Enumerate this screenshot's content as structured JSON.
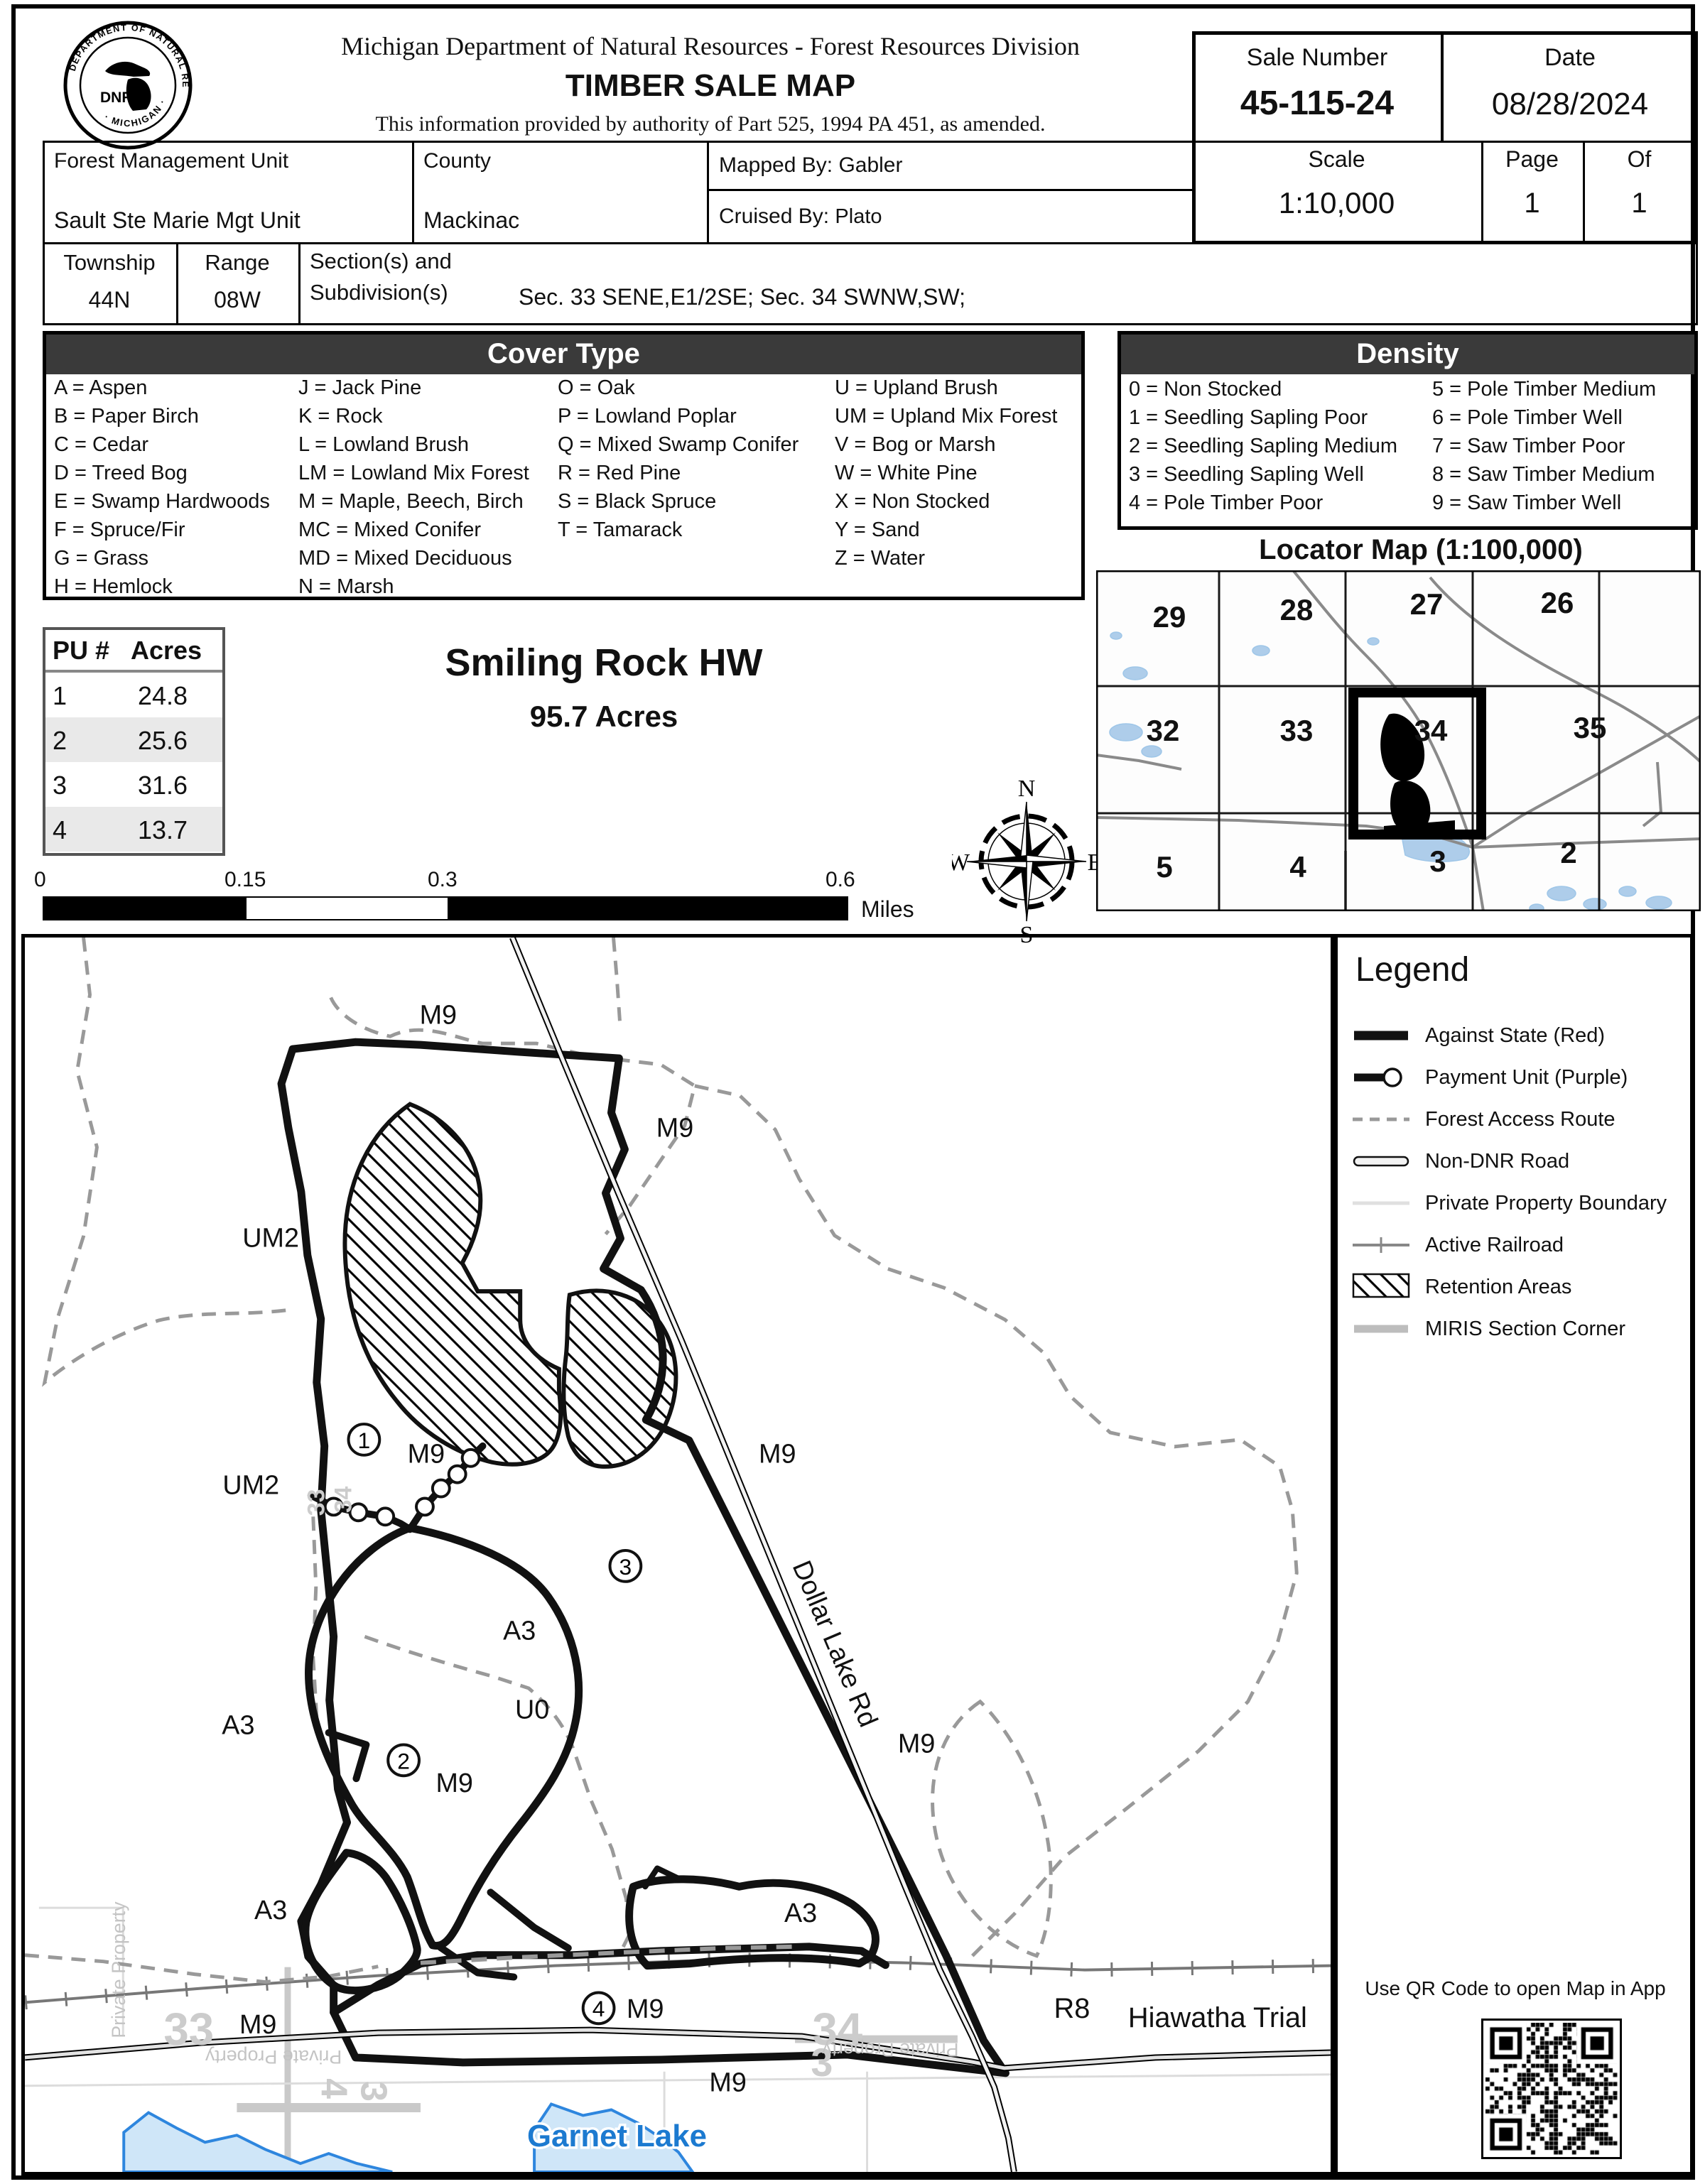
{
  "header": {
    "agency_line": "Michigan Department of Natural Resources - Forest Resources Division",
    "title": "TIMBER SALE MAP",
    "authority_line": "This information provided by authority of Part 525, 1994 PA 451, as amended.",
    "sale_number_label": "Sale Number",
    "sale_number": "45-115-24",
    "date_label": "Date",
    "date": "08/28/2024"
  },
  "logo": {
    "arc_top": "DEPARTMENT OF NATURAL RESOURCES",
    "arc_bottom": "· MICHIGAN ·",
    "dnr": "DNR"
  },
  "info_table": {
    "fmu_label": "Forest Management Unit",
    "fmu_value": "Sault Ste Marie Mgt Unit",
    "county_label": "County",
    "county_value": "Mackinac",
    "mapped_by_label": "Mapped By:",
    "mapped_by_value": "Gabler",
    "cruised_by_label": "Cruised By:",
    "cruised_by_value": "Plato",
    "scale_label": "Scale",
    "scale_value": "1:10,000",
    "page_label": "Page",
    "page_value": "1",
    "of_label": "Of",
    "of_value": "1",
    "township_label": "Township",
    "township_value": "44N",
    "range_label": "Range",
    "range_value": "08W",
    "sections_label_line1": "Section(s) and",
    "sections_label_line2": "Subdivision(s)",
    "sections_value": "Sec. 33 SENE,E1/2SE; Sec. 34 SWNW,SW;"
  },
  "cover_type": {
    "title": "Cover Type",
    "col1": [
      "A = Aspen",
      "B = Paper Birch",
      "C = Cedar",
      "D = Treed Bog",
      "E = Swamp Hardwoods",
      "F = Spruce/Fir",
      "G = Grass",
      "H = Hemlock"
    ],
    "col2": [
      "J = Jack Pine",
      "K = Rock",
      "L = Lowland Brush",
      "LM = Lowland Mix Forest",
      "M = Maple, Beech, Birch",
      "MC = Mixed Conifer",
      "MD = Mixed Deciduous",
      "N = Marsh"
    ],
    "col3": [
      "O = Oak",
      "P = Lowland Poplar",
      "Q = Mixed Swamp Conifer",
      "R = Red Pine",
      "S = Black Spruce",
      "T = Tamarack"
    ],
    "col4": [
      "U = Upland Brush",
      "UM = Upland Mix Forest",
      "V = Bog or Marsh",
      "W = White Pine",
      "X = Non Stocked",
      "Y = Sand",
      "Z = Water"
    ]
  },
  "density": {
    "title": "Density",
    "col1": [
      "0 = Non Stocked",
      "1 = Seedling Sapling Poor",
      "2 = Seedling Sapling Medium",
      "3 = Seedling Sapling Well",
      "4 = Pole Timber Poor"
    ],
    "col2": [
      "5 = Pole Timber Medium",
      "6 = Pole Timber Well",
      "7 = Saw Timber Poor",
      "8 = Saw Timber Medium",
      "9 = Saw Timber Well"
    ]
  },
  "pu_table": {
    "header": [
      "PU #",
      "Acres"
    ],
    "rows": [
      [
        "1",
        "24.8"
      ],
      [
        "2",
        "25.6"
      ],
      [
        "3",
        "31.6"
      ],
      [
        "4",
        "13.7"
      ]
    ]
  },
  "sale": {
    "name": "Smiling Rock HW",
    "acres": "95.7 Acres"
  },
  "locator": {
    "title": "Locator Map (1:100,000)",
    "sections_row1": [
      "29",
      "28",
      "27",
      "26"
    ],
    "sections_row2": [
      "32",
      "33",
      "34",
      "35"
    ],
    "sections_row3": [
      "5",
      "4",
      "3",
      "2"
    ]
  },
  "compass": {
    "n": "N",
    "e": "E",
    "s": "S",
    "w": "W"
  },
  "scale_bar": {
    "ticks": [
      "0",
      "0.15",
      "0.3",
      "0.6"
    ],
    "unit": "Miles"
  },
  "legend": {
    "title": "Legend",
    "items": [
      "Against State (Red)",
      "Payment Unit (Purple)",
      "Forest Access Route",
      "Non-DNR Road",
      "Private Property Boundary",
      "Active Railroad",
      "Retention Areas",
      "MIRIS Section Corner"
    ]
  },
  "qr": {
    "caption": "Use QR Code to open Map in App"
  },
  "map": {
    "labels": {
      "m9": "M9",
      "um2": "UM2",
      "a3": "A3",
      "u0": "U0",
      "r8": "R8",
      "unit_1": "1",
      "unit_2": "2",
      "unit_3": "3",
      "unit_4": "4",
      "dollar_lake_rd": "Dollar Lake Rd",
      "hiawatha_trail": "Hiawatha Trial",
      "garnet_lake": "Garnet Lake",
      "private_property": "Private Property",
      "section_33": "33",
      "section_34": "34",
      "section_3": "3",
      "section_4": "4"
    }
  },
  "colors": {
    "header_bar": "#3a3a3a",
    "water_fill": "#cfe6f8",
    "water_stroke": "#2e86de",
    "route_gray": "#999999",
    "miris_gray": "#c9c9c9"
  }
}
